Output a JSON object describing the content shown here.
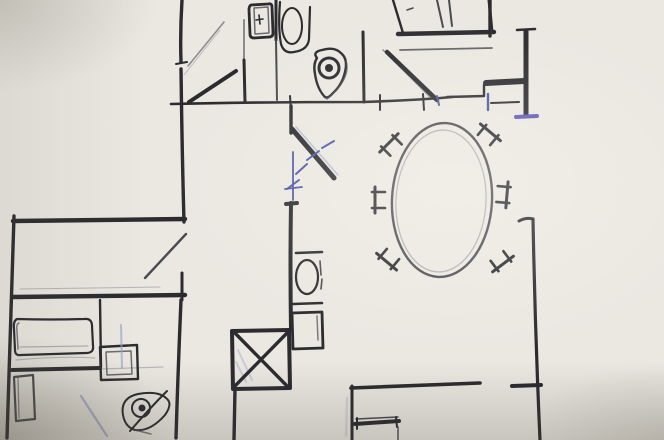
{
  "meta": {
    "kind": "photograph of a hand-drawn architectural floor-plan sketch",
    "medium": "black ink and pencil with blue-pen marks on squared graph paper",
    "visible_text": "none",
    "canvas": {
      "width": 664,
      "height": 440
    }
  },
  "palette": {
    "paper": "#eae8e1",
    "grid": "#b9b3a4",
    "ink": "#2b2b30",
    "ink_medium": "#4a4a52",
    "pencil": "#8a8a90",
    "blue_pen": "#4b54a8",
    "blue_pencil": "#9aa0cc",
    "purple_pen": "#6257b5"
  },
  "scene": {
    "rooms": [
      {
        "name": "top-left-room",
        "note": "large empty room, door with swing arc at its top-right corner"
      },
      {
        "name": "top-bathroom",
        "note": "small WC with toilet (tank + bowl) and a drop-shaped hand sink"
      },
      {
        "name": "top-right-room",
        "note": "room with rectangular furniture against top edge, door leaf swinging in, thick wall stub with purple end cap"
      },
      {
        "name": "dining-area",
        "note": "large oval table with six chair symbols around it"
      },
      {
        "name": "left-corridor",
        "note": "horizontal hallway band with an open door leaf"
      },
      {
        "name": "bottom-left-bedroom",
        "note": "bed with thick foot line, nightstand with inner box, small tall cabinet, eye-shaped sink, blue door swing"
      },
      {
        "name": "center-shaft",
        "note": "square crossed with an X (stair/elevator shaft), mid toilet and square appliance beside it"
      },
      {
        "name": "bottom-right-room",
        "note": "room below dining area with small bench/desk on its left wall"
      }
    ],
    "fixtures": [
      "toilet-top (tank with button + bowl)",
      "hand-sink-top (drop/pin shape with faucet circle)",
      "toilet-mid (bar + oval bowl + square tank)",
      "appliance-box (square with inner line)",
      "dining-table-oval (double outline)",
      "dining-chairs (6, two-leg + crossbar glyphs)",
      "bed (rounded mattress outline)",
      "nightstand (box in box)",
      "cabinet-tall (narrow rectangle)",
      "bedroom-sink (almond shape, ringed drain, diagonal faucet stroke)",
      "x-shaft-box (square with both diagonals)",
      "bench-desk (thick bar with legs)"
    ],
    "annotations": [
      "blue hatch ticks along centre door diagonal",
      "blue vertical dimension line with crossbar",
      "purple end-caps on thick top-right wall",
      "blue door-jamb ticks on top wall",
      "light-blue pencil smudges in shaft box and over nightstand",
      "light-blue door swing line in bedroom"
    ]
  }
}
